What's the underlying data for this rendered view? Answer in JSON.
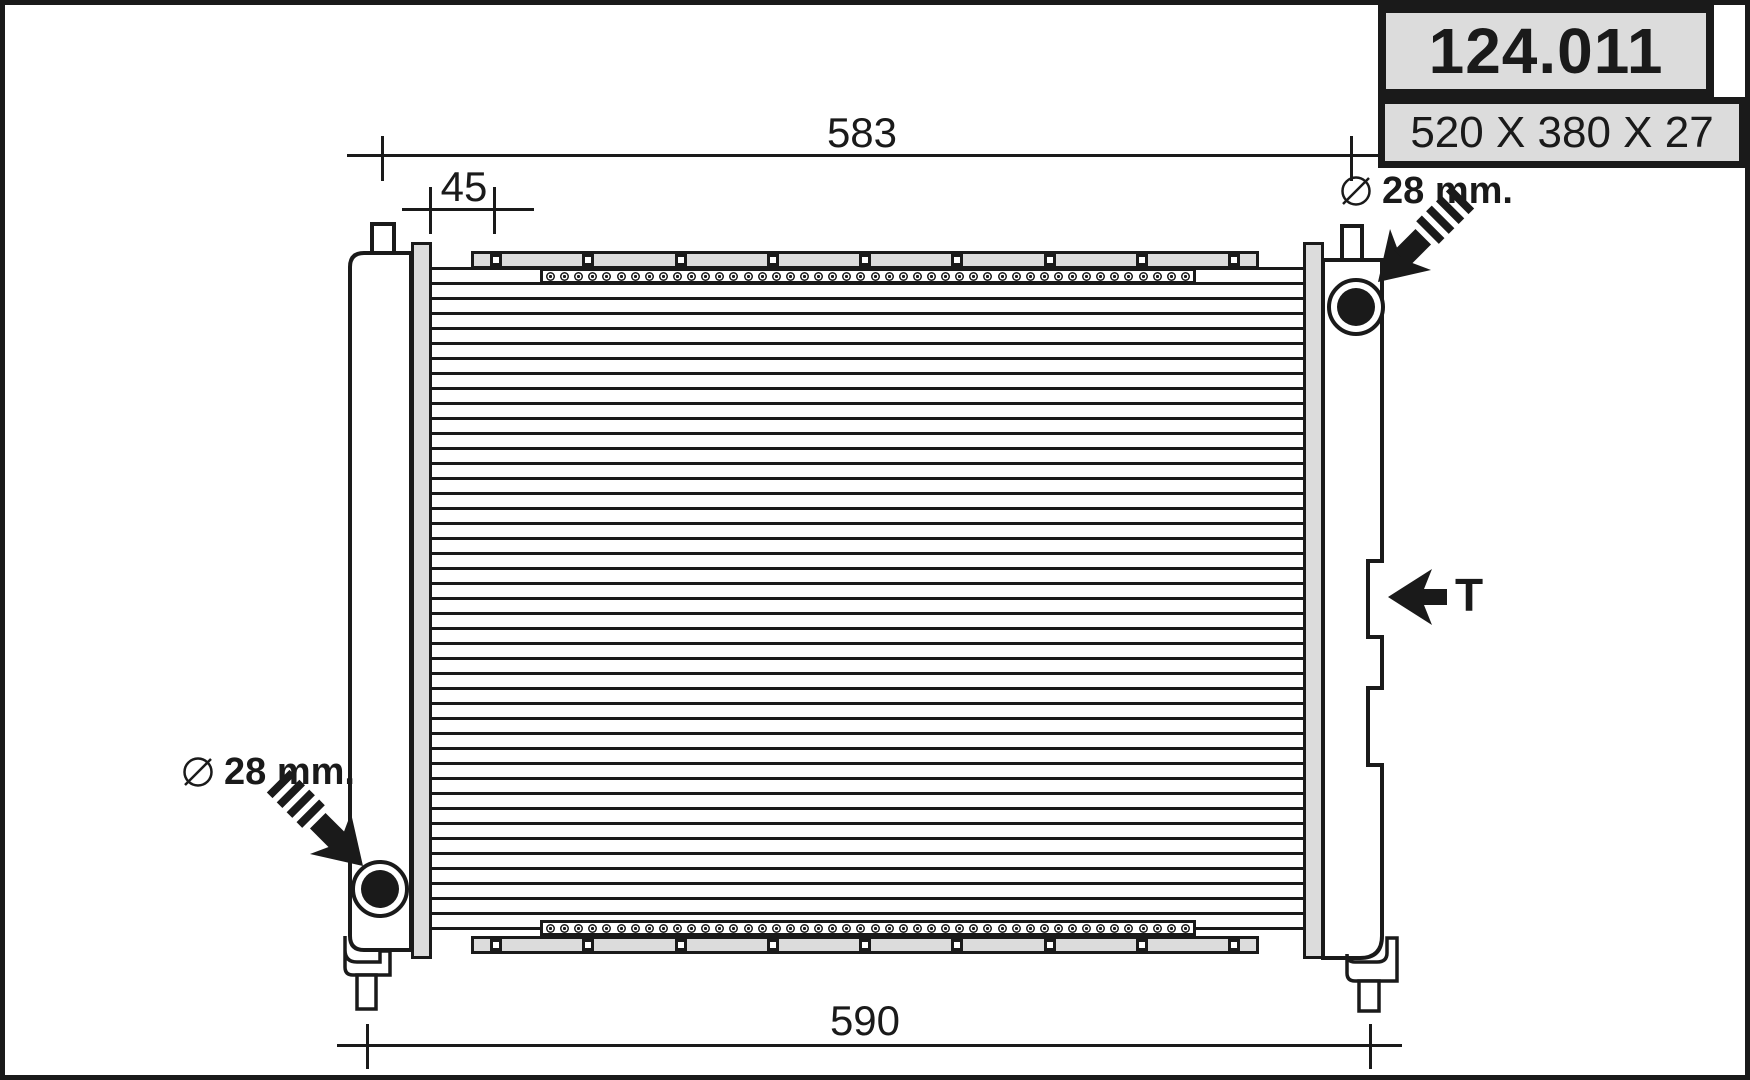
{
  "header": {
    "part_number": "124.011",
    "size": "520 X 380 X 27"
  },
  "dimensions": {
    "overall_top": "583",
    "inlet_offset": "45",
    "overall_bottom": "590"
  },
  "annotations": {
    "inlet_diameter": "28 mm.",
    "outlet_diameter": "28 mm.",
    "thermo_switch": "T"
  },
  "colors": {
    "line": "#1a1a1a",
    "panel_gray": "#dcdcdc",
    "background": "#ffffff"
  },
  "core": {
    "tube_line_count": 45,
    "fin_circle_count": 46,
    "bracket_hole_count": 9
  }
}
